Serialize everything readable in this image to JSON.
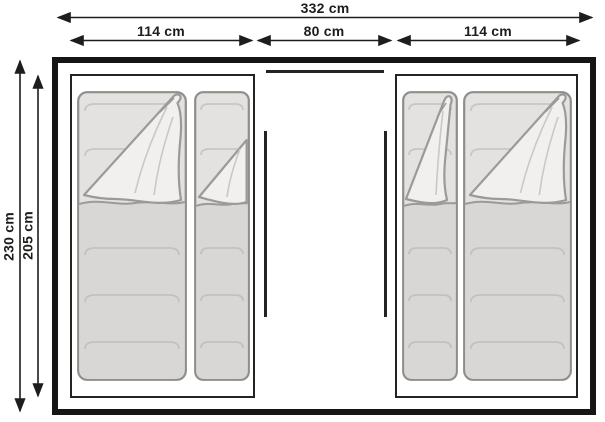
{
  "diagram": {
    "title": "tent-floorplan",
    "dimensions": {
      "total_width": "332 cm",
      "left_cabin_width": "114 cm",
      "center_width": "80 cm",
      "right_cabin_width": "114 cm",
      "outer_depth": "230 cm",
      "inner_depth": "205 cm"
    },
    "colors": {
      "line": "#1d1d1b",
      "wall": "#151513",
      "bag_fill": "#e3e2e0",
      "bag_foot_fill": "#d8d7d5",
      "flap_fill": "#f1f0ee",
      "bag_stroke": "#8f8e8a",
      "seam": "#c7c6c3"
    }
  }
}
